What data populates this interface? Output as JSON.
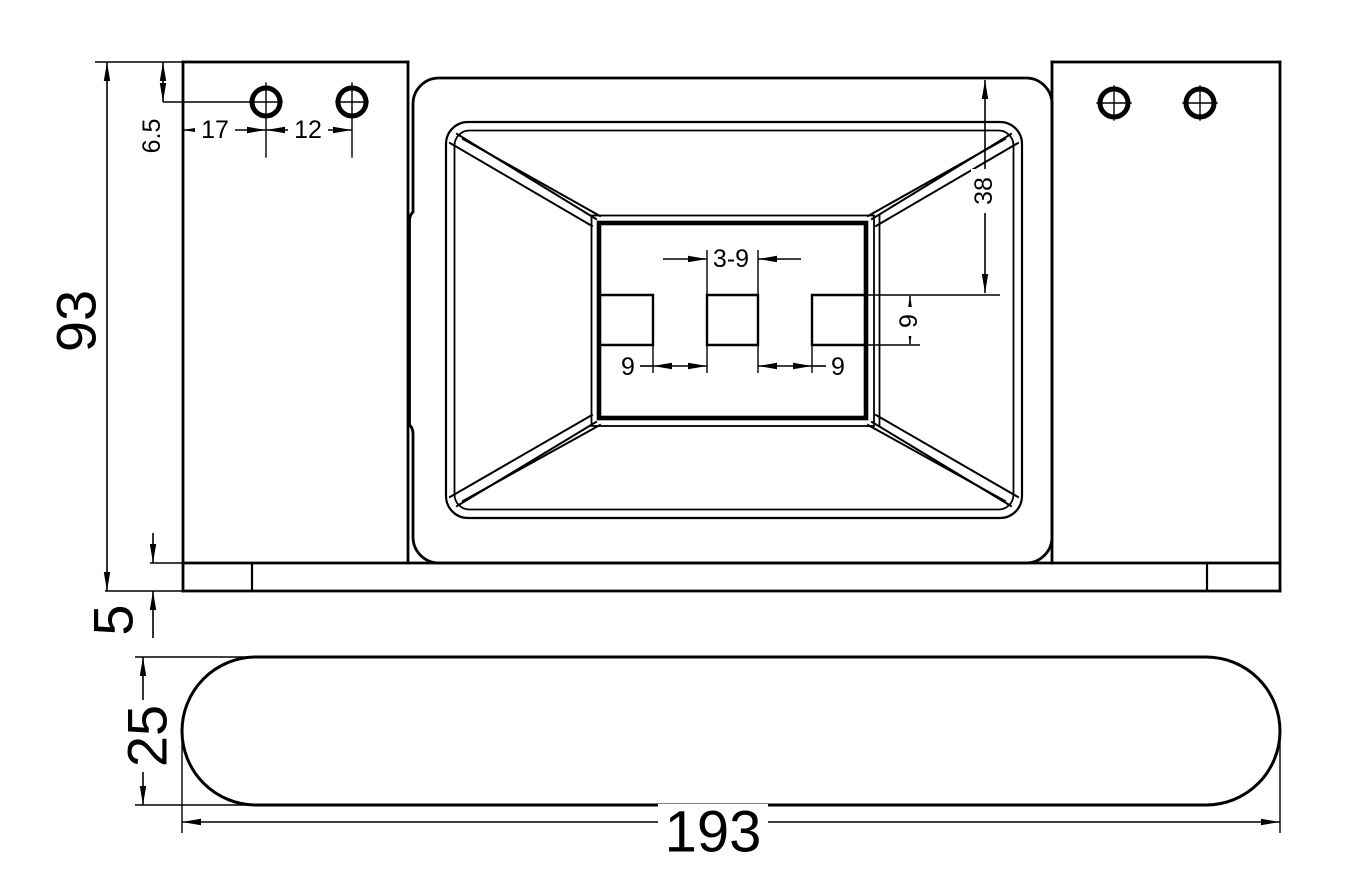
{
  "drawing": {
    "type": "engineering-dimension-drawing",
    "views": {
      "top_view": "part top view with center pocket and mounting holes",
      "side_view": "stadium shaped base profile"
    },
    "dims": {
      "height_overall": "93",
      "hole_offset_vertical": "6.5",
      "hole_edge_distance": "17",
      "hole_pitch": "12",
      "slot_depth_from_top": "38",
      "slot_count_size": "3-9",
      "slot_gap_left": "9",
      "slot_gap_right": "9",
      "slot_height": "9",
      "step_height": "5",
      "base_thickness": "25",
      "length_overall": "193"
    },
    "line_color": "#000000",
    "background": "#ffffff"
  }
}
